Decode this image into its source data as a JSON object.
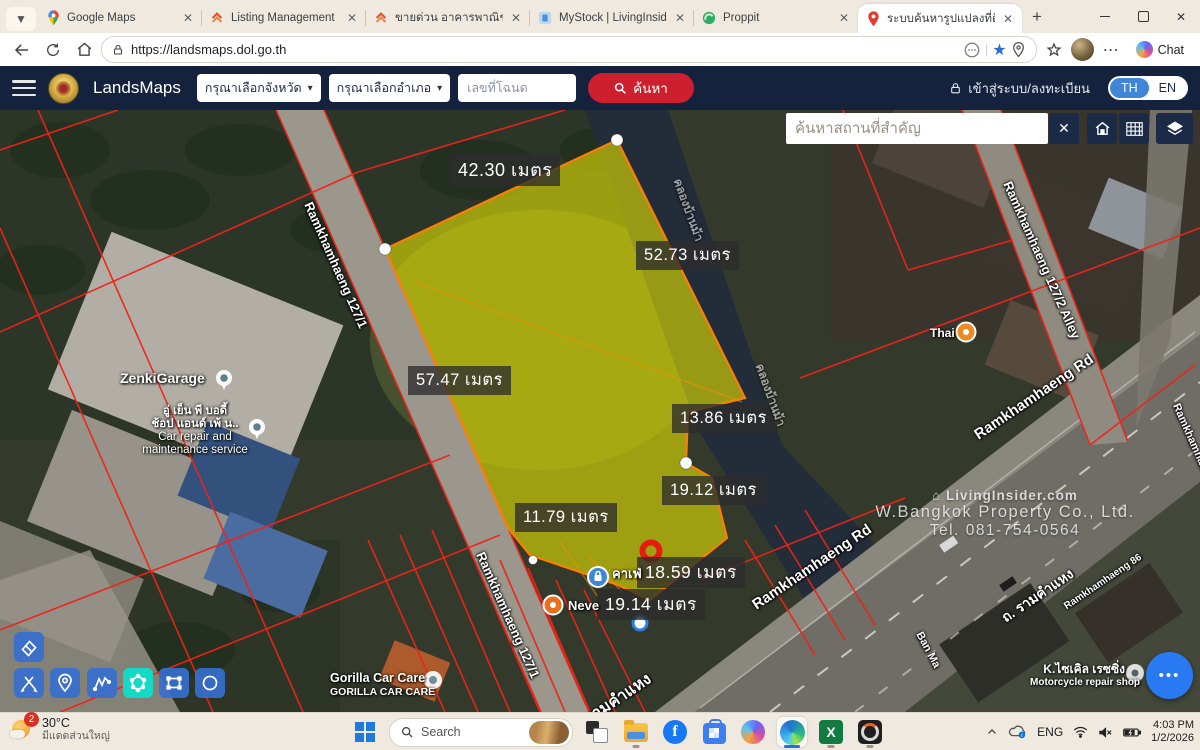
{
  "browser": {
    "tabs": [
      {
        "title": "Google Maps"
      },
      {
        "title": "Listing Management"
      },
      {
        "title": "ขายด่วน อาคารพาณิชย์ 3.5 ชั้น"
      },
      {
        "title": "MyStock | LivingInsider.com"
      },
      {
        "title": "Proppit"
      },
      {
        "title": "ระบบค้นหารูปแปลงที่ดิน (Lands"
      }
    ],
    "new_tab": "+",
    "url": "https://landsmaps.dol.go.th",
    "chat_button": "Chat"
  },
  "app_header": {
    "brand": "LandsMaps",
    "province_dropdown": "กรุณาเลือกจังหวัด",
    "district_dropdown": "กรุณาเลือกอำเภอ",
    "deed_placeholder": "เลขที่โฉนด",
    "search_button": "ค้นหา",
    "login": "เข้าสู่ระบบ/ลงทะเบียน",
    "lang_th": "TH",
    "lang_en": "EN"
  },
  "map": {
    "poi_search_placeholder": "ค้นหาสถานที่สำคัญ",
    "close_button": "✕",
    "measurements": [
      {
        "text": "42.30 เมตร"
      },
      {
        "text": "52.73 เมตร"
      },
      {
        "text": "57.47 เมตร"
      },
      {
        "text": "13.86 เมตร"
      },
      {
        "text": "19.12 เมตร"
      },
      {
        "text": "11.79 เมตร"
      },
      {
        "text": "18.59 เมตร"
      },
      {
        "text": "19.14 เมตร"
      }
    ],
    "streets": [
      {
        "text": "Ramkhamhaeng 127/1"
      },
      {
        "text": "Ramkhamhaeng 127/1"
      },
      {
        "text": "Ramkhamhaeng 127/2 Alley"
      },
      {
        "text": "Ramkhamhaeng Rd"
      },
      {
        "text": "Ramkhamhaeng Rd"
      },
      {
        "text": "ถ. รามคำแหง"
      },
      {
        "text": "รามคำแหง"
      },
      {
        "text": "Ramkhamhaeng 86"
      },
      {
        "text": "Ramkhamhaeng 88"
      },
      {
        "text": "Ban Ma"
      },
      {
        "text": "คลองบ้านม้า"
      },
      {
        "text": "คลองบ้านม้า"
      }
    ],
    "places": {
      "zenki": "ZenkiGarage",
      "car_repair_line1": "อู่ เย็น พี บอดี้",
      "car_repair_line2": "ช้อป แอนด์ เพ้ น..",
      "car_repair_line3": "Car repair and",
      "car_repair_line4": "maintenance service",
      "thai": "Thai",
      "cafe": "คาเฟ่",
      "neve": "Neve",
      "gorilla_line1": "Gorilla Car Care",
      "gorilla_line2": "GORILLA CAR CARE",
      "kcycle_line1": "K.ไซเคิล เรซซิ่ง",
      "kcycle_line2": "Motorcycle repair shop"
    },
    "watermark": {
      "line1": "⌂ LivingInsider.com",
      "line2": "W.Bangkok Property Co., Ltd.",
      "line3": "Tel. 081-754-0564"
    },
    "fab_dots": "•••"
  },
  "taskbar": {
    "weather_badge": "2",
    "weather_temp": "30°C",
    "weather_desc": "มีแดดส่วนใหญ่",
    "search_label": "Search",
    "excel_glyph": "X",
    "fb_glyph": "f",
    "tray_lang": "ENG",
    "time": "4:03 PM",
    "date": "1/2/2026"
  },
  "colors": {
    "header_navy": "#15223e",
    "search_red": "#ce1f2e",
    "lang_active_blue": "#3f86d8",
    "parcel_yellow": "#e6e400",
    "parcel_stroke": "#ff7d05",
    "cadastral_red": "#ef2318",
    "active_tool_teal": "#14d9c4",
    "fab_blue": "#2979f2"
  }
}
